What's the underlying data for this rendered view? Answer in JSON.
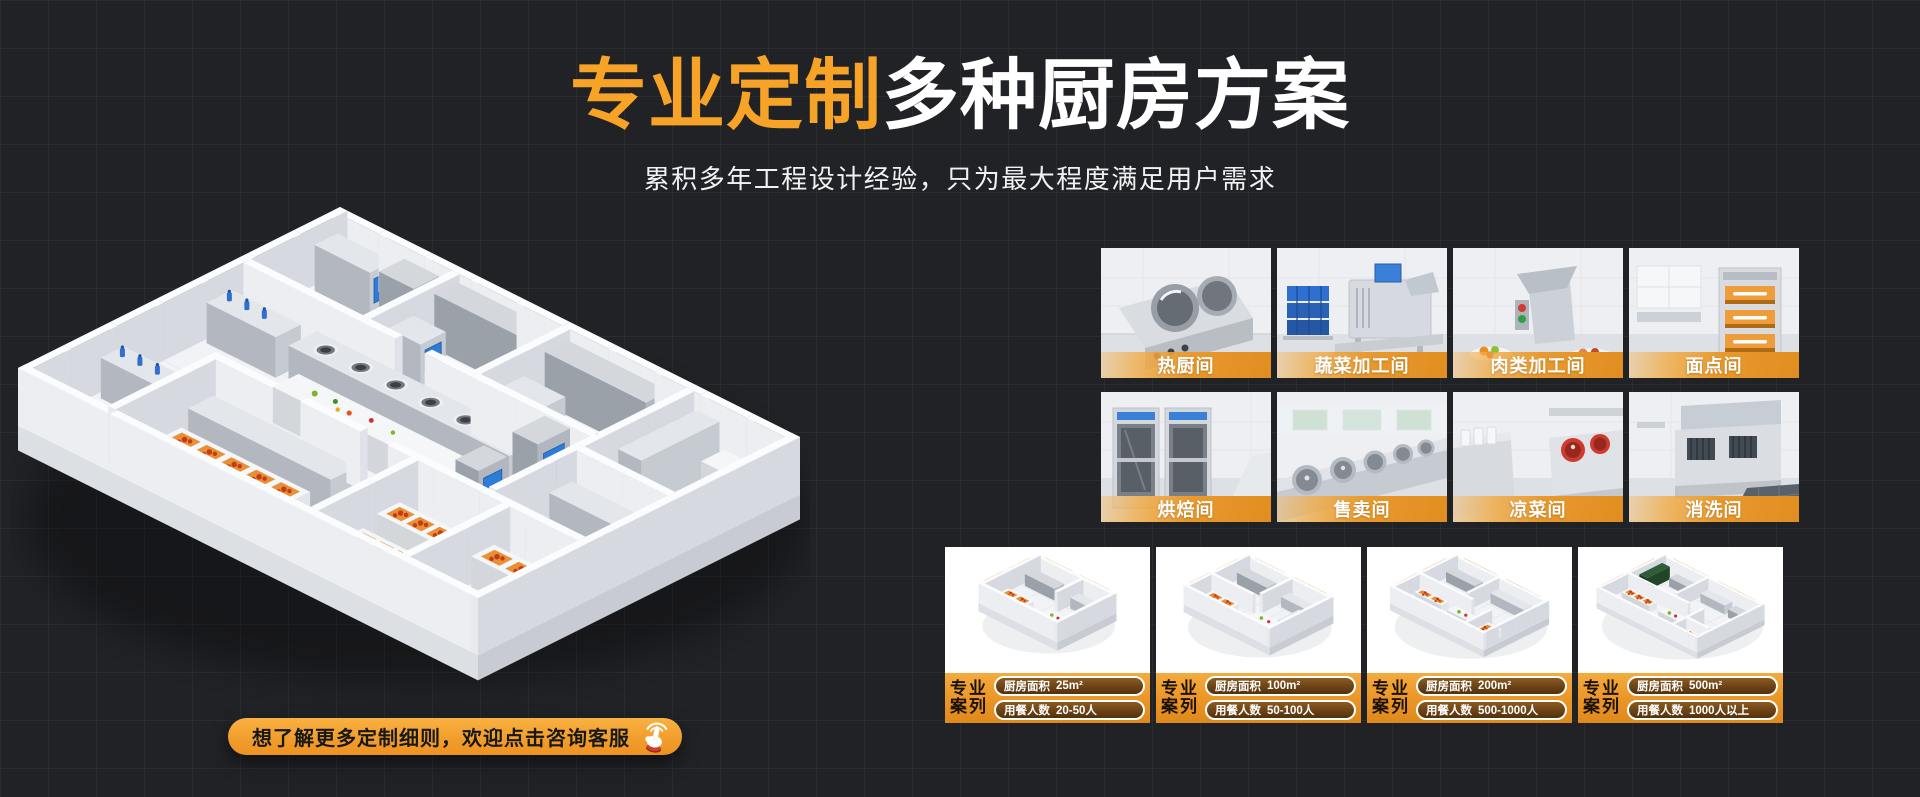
{
  "theme": {
    "accent_orange": "#F7A327",
    "label_bar_orange": "#E8992D",
    "background": "#212226",
    "screen_blue": "#2F7CD8",
    "tray_orange": "#E89038"
  },
  "header": {
    "title_highlight": "专业定制",
    "title_rest": "多种厨房方案",
    "subtitle": "累积多年工程设计经验，只为最大程度满足用户需求"
  },
  "rooms": {
    "items": [
      {
        "label": "热厨间"
      },
      {
        "label": "蔬菜加工间"
      },
      {
        "label": "肉类加工间"
      },
      {
        "label": "面点间"
      },
      {
        "label": "烘焙间"
      },
      {
        "label": "售卖间"
      },
      {
        "label": "凉菜间"
      },
      {
        "label": "消洗间"
      }
    ]
  },
  "cases": {
    "badge_top": "专业",
    "badge_bottom": "案列",
    "items": [
      {
        "area_label": "厨房面积",
        "area_value": "25m²",
        "diners_label": "用餐人数",
        "diners_value": "20-50人"
      },
      {
        "area_label": "厨房面积",
        "area_value": "100m²",
        "diners_label": "用餐人数",
        "diners_value": "50-100人"
      },
      {
        "area_label": "厨房面积",
        "area_value": "200m²",
        "diners_label": "用餐人数",
        "diners_value": "500-1000人"
      },
      {
        "area_label": "厨房面积",
        "area_value": "500m²",
        "diners_label": "用餐人数",
        "diners_value": "1000人以上"
      }
    ]
  },
  "cta": {
    "label": "想了解更多定制细则，欢迎点击咨询客服"
  }
}
